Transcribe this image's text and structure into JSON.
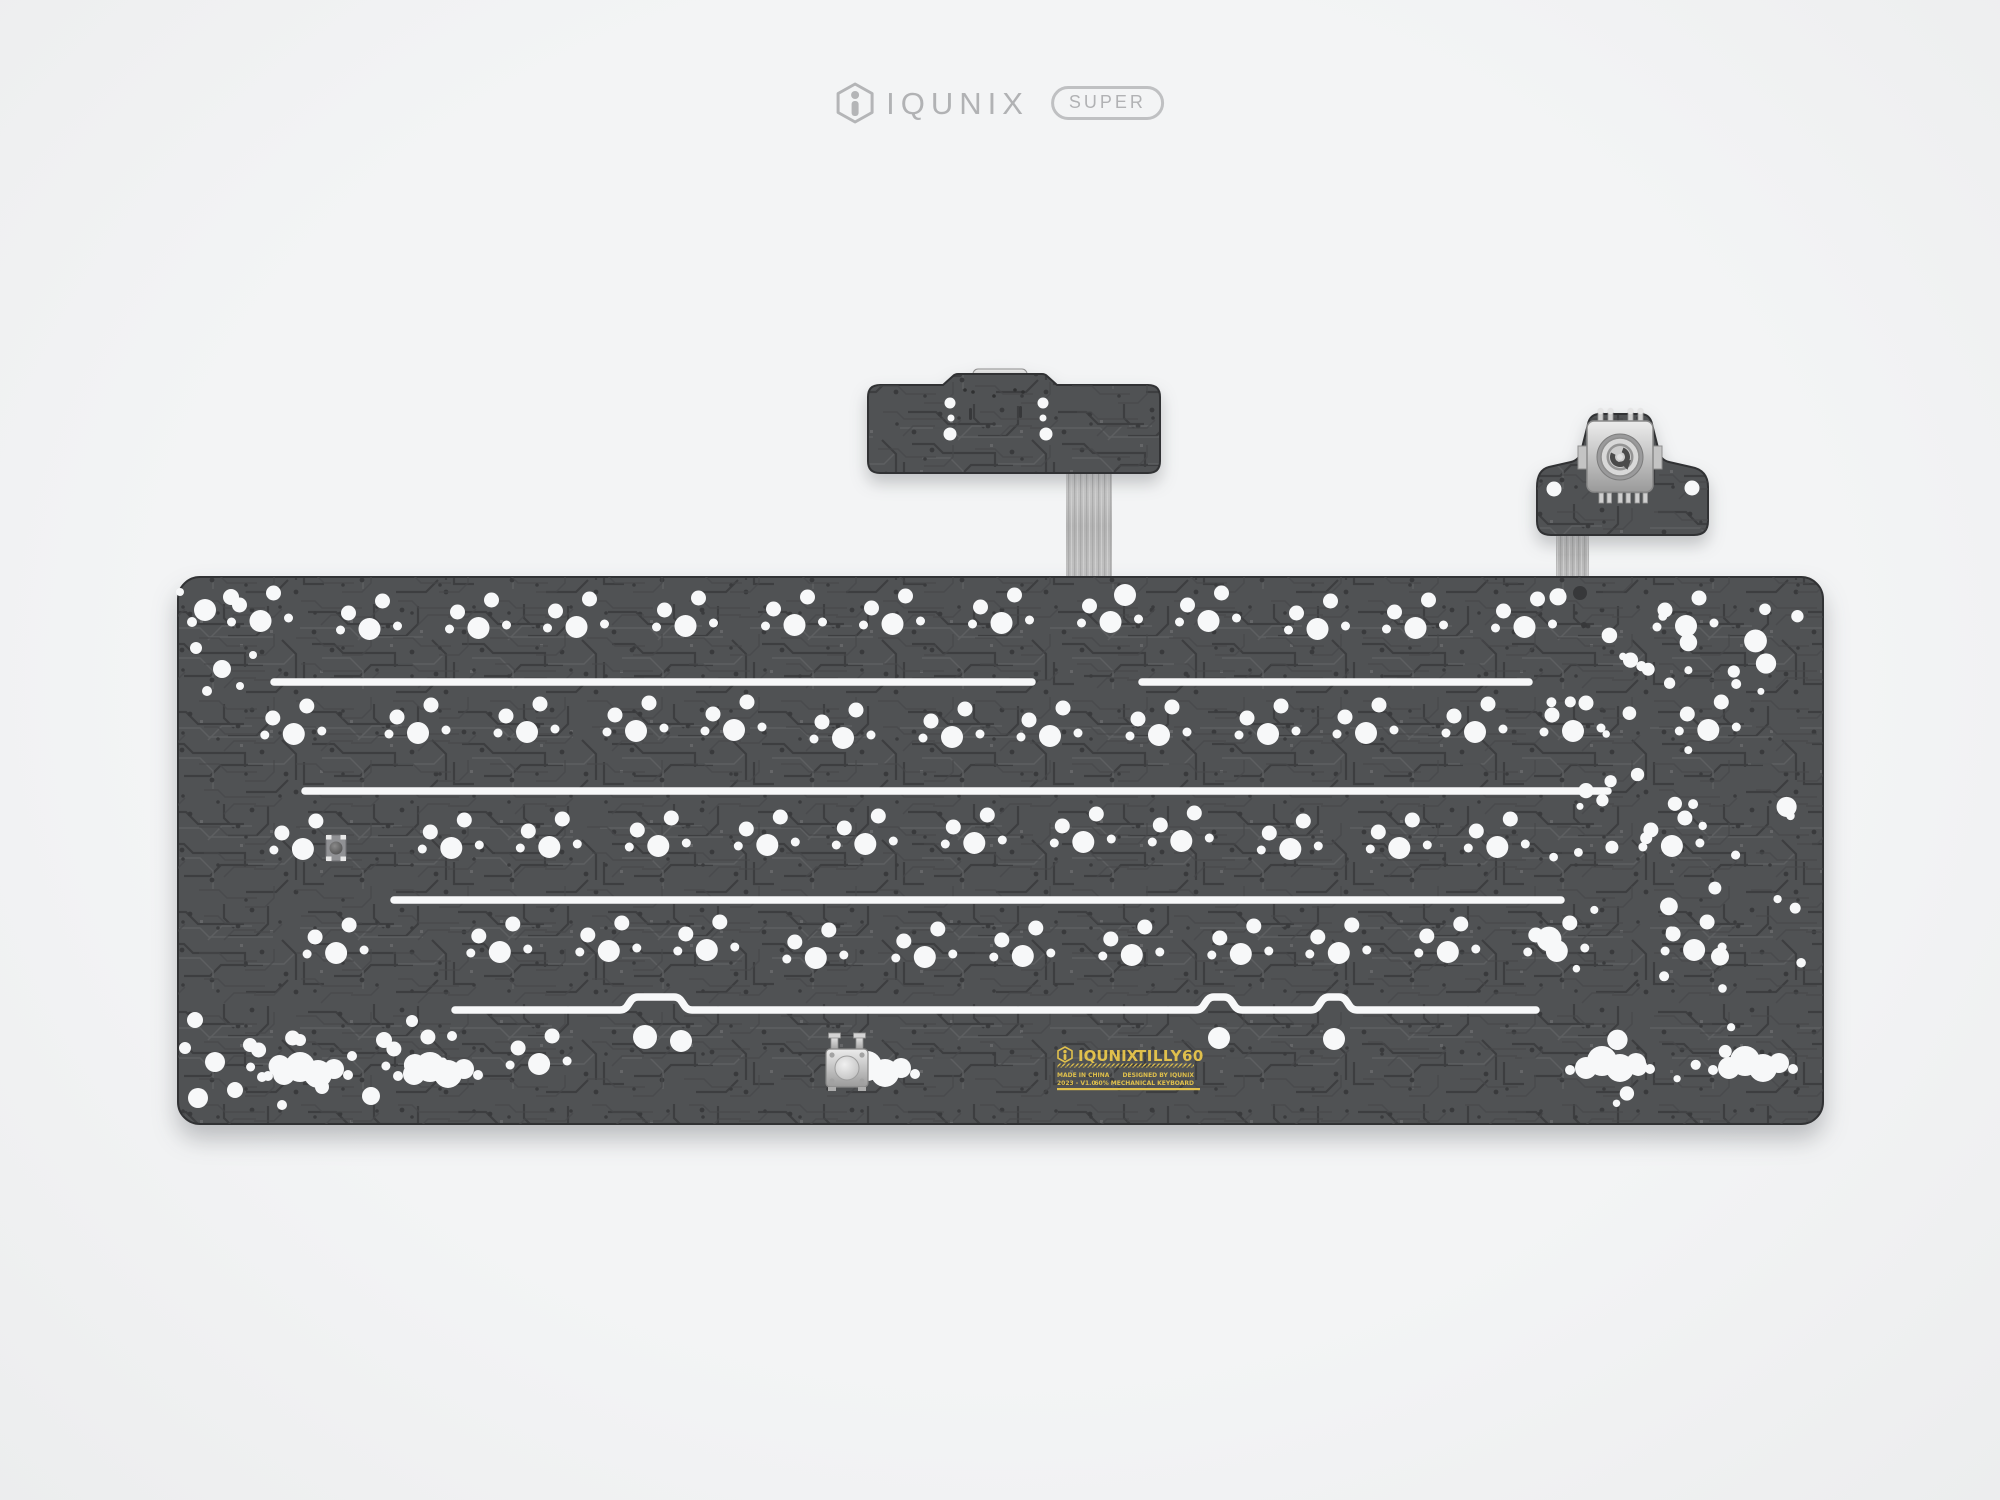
{
  "page": {
    "background": "#f0f1f2"
  },
  "header": {
    "brand": "IQUNIX",
    "badge": "SUPER",
    "color": "#b1b2b4"
  },
  "pcb_label": {
    "brand": "IQUNIX",
    "model": "TILLY60",
    "made_in": "MADE IN CHINA",
    "version": "2023 - V1.0",
    "designed_by": "DESIGNED BY IQUNIX",
    "board_type": "60% MECHANICAL KEYBOARD",
    "color": "#e0c04c"
  },
  "colors": {
    "board_base": "#505254",
    "trace_dark": "#3d3e40",
    "trace_light": "#5e6062",
    "board_edge": "#313234",
    "hole": "#f7f8f9",
    "dark_hole": "#37383a",
    "metal_light": "#e6e6e6",
    "metal_dark": "#8d8d8d",
    "cable": "#c9c9c9",
    "label_yellow": "#e0c04c"
  },
  "geometry": {
    "board": {
      "x": 178,
      "y": 577,
      "w": 1645,
      "h": 547,
      "r": 22,
      "unit": 105,
      "x0": 213
    },
    "rows": [
      {
        "y": 625,
        "widths": [
          1,
          1,
          1,
          1,
          1,
          1,
          1,
          1,
          1,
          1,
          1,
          1,
          1,
          2
        ]
      },
      {
        "y": 734,
        "widths": [
          1.5,
          1,
          1,
          1,
          1,
          1,
          1,
          1,
          1,
          1,
          1,
          1,
          1,
          1.5
        ]
      },
      {
        "y": 845,
        "widths": [
          1.75,
          1,
          1,
          1,
          1,
          1,
          1,
          1,
          1,
          1,
          1,
          1,
          2.25
        ]
      },
      {
        "y": 954,
        "widths": [
          2.25,
          1,
          1,
          1,
          1,
          1,
          1,
          1,
          1,
          1,
          1,
          1,
          1.75
        ]
      },
      {
        "y": 1063,
        "widths": [
          1.25,
          1.25,
          1.25
        ]
      }
    ],
    "cluster": [
      [
        0,
        0,
        11
      ],
      [
        -21,
        -16,
        7.5
      ],
      [
        13,
        -28,
        7.5
      ],
      [
        -29,
        1,
        4.5
      ],
      [
        28,
        -3,
        4.5
      ]
    ],
    "slits": [
      [
        274,
        1032,
        682
      ],
      [
        1142,
        1529,
        682
      ],
      [
        305,
        1608,
        791
      ],
      [
        394,
        1561,
        900
      ]
    ],
    "bumped_slit": {
      "x1": 455,
      "x2": 1536,
      "y": 1010,
      "bumps": [
        {
          "x": 656,
          "hw": 36
        },
        {
          "x": 1219,
          "hw": 23
        },
        {
          "x": 1334,
          "hw": 23
        }
      ]
    },
    "bump_holes": [
      [
        645,
        1037,
        12
      ],
      [
        681,
        1041,
        11
      ],
      [
        1219,
        1038,
        11
      ],
      [
        1334,
        1039,
        11
      ]
    ],
    "blob_shape": [
      [
        -24,
        2,
        11
      ],
      [
        -8,
        -5,
        15
      ],
      [
        10,
        2,
        14
      ],
      [
        26,
        -3,
        10
      ],
      [
        -40,
        4,
        5
      ],
      [
        40,
        3,
        5
      ]
    ],
    "blobs": [
      [
        308,
        1072
      ],
      [
        438,
        1072
      ],
      [
        875,
        1071
      ],
      [
        1610,
        1066
      ],
      [
        1753,
        1066
      ]
    ],
    "extra_holes": [
      [
        205,
        610,
        11
      ],
      [
        231,
        597,
        8
      ],
      [
        196,
        648,
        6
      ],
      [
        222,
        669,
        9
      ],
      [
        207,
        691,
        5
      ],
      [
        240,
        686,
        4
      ],
      [
        192,
        622,
        5
      ],
      [
        253,
        655,
        4
      ],
      [
        180,
        592,
        4
      ],
      [
        195,
        1020,
        8
      ],
      [
        185,
        1048,
        6
      ],
      [
        215,
        1062,
        10
      ],
      [
        250,
        1045,
        7
      ],
      [
        235,
        1090,
        8
      ],
      [
        198,
        1098,
        10
      ],
      [
        262,
        1077,
        5
      ],
      [
        300,
        1040,
        6
      ],
      [
        322,
        1087,
        7
      ],
      [
        282,
        1105,
        5
      ],
      [
        352,
        1056,
        5
      ],
      [
        384,
        1040,
        8
      ],
      [
        371,
        1096,
        9
      ],
      [
        412,
        1021,
        6
      ],
      [
        452,
        1036,
        5
      ],
      [
        1125,
        595,
        11
      ]
    ],
    "dark_holes": [
      [
        1580,
        593,
        7
      ],
      [
        1584,
        625,
        3
      ]
    ],
    "scatter": {
      "x1": 1543,
      "y1": 592,
      "x2": 1806,
      "y2": 1106,
      "count": 62,
      "rmin": 3.5,
      "rmax": 13,
      "seed": 11
    },
    "daughterboard": {
      "holes": [
        [
          950,
          403,
          5.5
        ],
        [
          1043,
          403,
          5.5
        ],
        [
          951,
          418,
          3.5
        ],
        [
          1043,
          418,
          3.5
        ],
        [
          950,
          434,
          6.5
        ],
        [
          1046,
          434,
          6.5
        ]
      ],
      "slots": [
        [
          969,
          408
        ],
        [
          1019,
          406
        ]
      ],
      "pins": [
        [
          965,
          390
        ],
        [
          973,
          392
        ],
        [
          1015,
          390
        ],
        [
          1023,
          392
        ],
        [
          994,
          396
        ]
      ]
    },
    "knob_wing_holes": [
      [
        1554,
        489,
        7.5
      ],
      [
        1692,
        488,
        7.5
      ]
    ],
    "reset_button": {
      "x": 847,
      "y": 1068
    },
    "led": {
      "x": 336,
      "y": 848
    }
  }
}
